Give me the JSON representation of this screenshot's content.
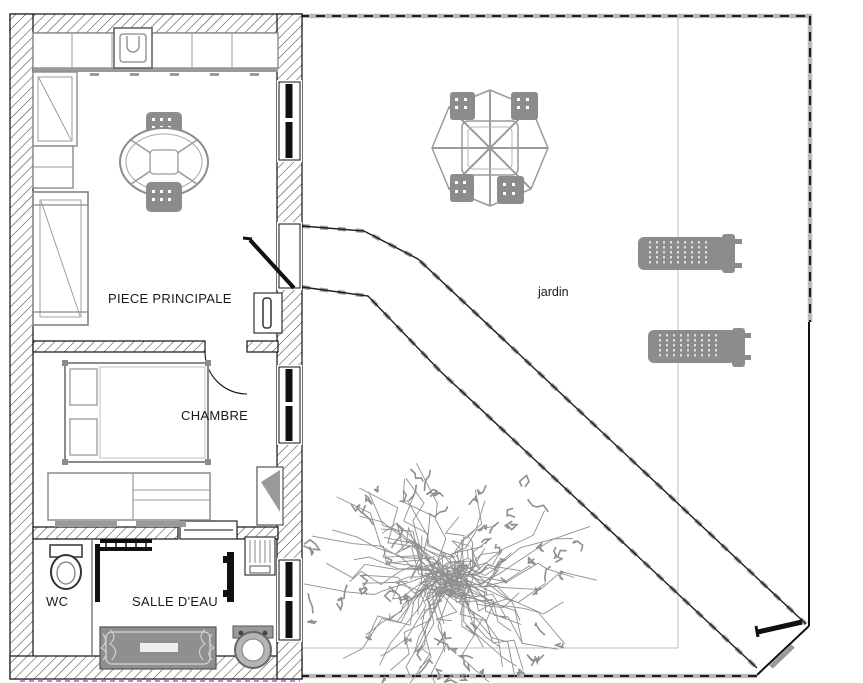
{
  "plan": {
    "labels": {
      "main_room": "PIECE PRINCIPALE",
      "bedroom": "CHAMBRE",
      "wc": "WC",
      "bathroom": "SALLE D'EAU",
      "garden": "jardin"
    },
    "colors": {
      "ink": "#1a1a1a",
      "wall_hatch": "#444444",
      "furniture_gray": "#8c8c8c",
      "light_line": "#bcbcbc",
      "tree_gray": "#8f8f8f",
      "property_line_purple": "#b55ab5",
      "paper": "#ffffff"
    }
  }
}
